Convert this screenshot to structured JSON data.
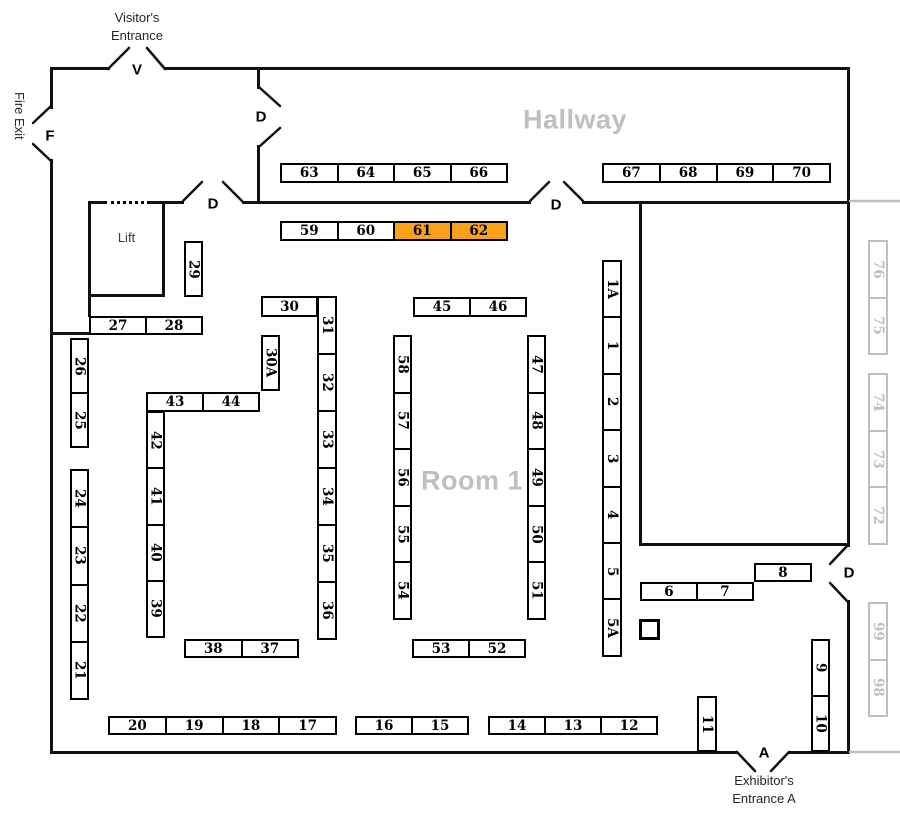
{
  "colors": {
    "highlight": "#F9A11B",
    "muted": "#BFBFBF",
    "wall": "#111111"
  },
  "rooms": [
    {
      "label": "Hallway",
      "x": 575,
      "y": 120
    },
    {
      "label": "Room 1",
      "x": 472,
      "y": 481
    }
  ],
  "lift": {
    "label": "Lift"
  },
  "entrances": {
    "visitor": {
      "lines": [
        "Visitor's",
        "Entrance"
      ]
    },
    "exhibitor": {
      "lines": [
        "Exhibitor's",
        "Entrance A"
      ]
    },
    "fire_exit": {
      "label": "Fire Exit"
    }
  },
  "markers": [
    {
      "label": "V",
      "x": 137,
      "y": 70
    },
    {
      "label": "F",
      "x": 50,
      "y": 136
    },
    {
      "label": "D",
      "x": 261,
      "y": 117
    },
    {
      "label": "D",
      "x": 213,
      "y": 204
    },
    {
      "label": "D",
      "x": 556,
      "y": 205
    },
    {
      "label": "D",
      "x": 849,
      "y": 573
    },
    {
      "label": "A",
      "x": 764,
      "y": 753
    }
  ],
  "highlighted_booths": [
    "61",
    "62"
  ],
  "booth_groups": [
    {
      "dir": "h",
      "x": 280,
      "y": 163,
      "cw": 57,
      "ch": 20,
      "cells": [
        "63",
        "64",
        "65",
        "66"
      ]
    },
    {
      "dir": "h",
      "x": 602,
      "y": 163,
      "cw": 57.25,
      "ch": 20,
      "cells": [
        "67",
        "68",
        "69",
        "70"
      ]
    },
    {
      "dir": "h",
      "x": 280,
      "y": 221,
      "cw": 57,
      "ch": 20,
      "cells": [
        "59",
        "60",
        "61",
        "62"
      ]
    },
    {
      "dir": "v",
      "x": 184,
      "y": 241,
      "cw": 19,
      "ch": 56,
      "cells": [
        "29"
      ]
    },
    {
      "dir": "h",
      "x": 89,
      "y": 316,
      "cw": 57,
      "ch": 19,
      "cells": [
        "27",
        "28"
      ]
    },
    {
      "dir": "v",
      "x": 70,
      "y": 338,
      "cw": 19,
      "ch": 55,
      "cells": [
        "26",
        "25"
      ]
    },
    {
      "dir": "v",
      "x": 70,
      "y": 469,
      "cw": 19,
      "ch": 57.75,
      "cells": [
        "24",
        "23",
        "22",
        "21"
      ]
    },
    {
      "dir": "h",
      "x": 146,
      "y": 392,
      "cw": 57,
      "ch": 20,
      "cells": [
        "43",
        "44"
      ]
    },
    {
      "dir": "v",
      "x": 146,
      "y": 411,
      "cw": 19,
      "ch": 56.75,
      "cells": [
        "42",
        "41",
        "40",
        "39"
      ]
    },
    {
      "dir": "h",
      "x": 261,
      "y": 296,
      "cw": 57,
      "ch": 21,
      "cells": [
        "30"
      ]
    },
    {
      "dir": "v",
      "x": 317,
      "y": 296,
      "cw": 20,
      "ch": 57.3,
      "cells": [
        "31",
        "32",
        "33",
        "34",
        "35",
        "36"
      ]
    },
    {
      "dir": "v",
      "x": 261,
      "y": 335,
      "cw": 19,
      "ch": 56,
      "cells": [
        "30A"
      ]
    },
    {
      "dir": "h",
      "x": 413,
      "y": 297,
      "cw": 57,
      "ch": 20,
      "cells": [
        "45",
        "46"
      ]
    },
    {
      "dir": "v",
      "x": 393,
      "y": 335,
      "cw": 19,
      "ch": 57,
      "cells": [
        "58",
        "57",
        "56",
        "55",
        "54"
      ]
    },
    {
      "dir": "v",
      "x": 527,
      "y": 335,
      "cw": 19,
      "ch": 57,
      "cells": [
        "47",
        "48",
        "49",
        "50",
        "51"
      ]
    },
    {
      "dir": "h",
      "x": 412,
      "y": 639,
      "cw": 57,
      "ch": 19,
      "cells": [
        "53",
        "52"
      ]
    },
    {
      "dir": "h",
      "x": 184,
      "y": 639,
      "cw": 57.5,
      "ch": 19,
      "cells": [
        "38",
        "37"
      ]
    },
    {
      "dir": "h",
      "x": 108,
      "y": 716,
      "cw": 57.25,
      "ch": 19,
      "cells": [
        "20",
        "19",
        "18",
        "17"
      ]
    },
    {
      "dir": "h",
      "x": 355,
      "y": 716,
      "cw": 57,
      "ch": 19,
      "cells": [
        "16",
        "15"
      ]
    },
    {
      "dir": "h",
      "x": 488,
      "y": 716,
      "cw": 56.7,
      "ch": 19,
      "cells": [
        "14",
        "13",
        "12"
      ]
    },
    {
      "dir": "v",
      "x": 602,
      "y": 260,
      "cw": 20,
      "ch": 56.7,
      "cells": [
        "1A",
        "1",
        "2",
        "3",
        "4",
        "5",
        "5A"
      ]
    },
    {
      "dir": "h",
      "x": 640,
      "y": 582,
      "cw": 57,
      "ch": 19,
      "cells": [
        "6",
        "7"
      ]
    },
    {
      "dir": "h",
      "x": 754,
      "y": 563,
      "cw": 58,
      "ch": 19,
      "cells": [
        "8"
      ]
    },
    {
      "dir": "v",
      "x": 811,
      "y": 639,
      "cw": 19,
      "ch": 56.5,
      "cells": [
        "9",
        "10"
      ]
    },
    {
      "dir": "v",
      "x": 697,
      "y": 696,
      "cw": 20,
      "ch": 56,
      "cells": [
        "11"
      ]
    },
    {
      "dir": "v",
      "x": 868,
      "y": 240,
      "cw": 20,
      "ch": 57.5,
      "muted": true,
      "cells": [
        "76",
        "75"
      ]
    },
    {
      "dir": "v",
      "x": 868,
      "y": 373,
      "cw": 20,
      "ch": 57.3,
      "muted": true,
      "cells": [
        "74",
        "73",
        "72"
      ]
    },
    {
      "dir": "v",
      "x": 868,
      "y": 602,
      "cw": 20,
      "ch": 57.5,
      "muted": true,
      "cells": [
        "99",
        "98"
      ]
    }
  ],
  "door_marks": [
    [
      108,
      69,
      129,
      48
    ],
    [
      147,
      48,
      165,
      69
    ],
    [
      50,
      107,
      33,
      123
    ],
    [
      33,
      144,
      50,
      160
    ],
    [
      260,
      88,
      280,
      106
    ],
    [
      280,
      128,
      260,
      146
    ],
    [
      183,
      201,
      202,
      182
    ],
    [
      223,
      182,
      242,
      201
    ],
    [
      530,
      201,
      549,
      182
    ],
    [
      564,
      182,
      583,
      201
    ],
    [
      847,
      546,
      830,
      564
    ],
    [
      830,
      583,
      847,
      601
    ],
    [
      737,
      752,
      755,
      771
    ],
    [
      771,
      771,
      789,
      752
    ]
  ],
  "gray_lines": [
    [
      850,
      201,
      900,
      201
    ],
    [
      850,
      752,
      900,
      752
    ]
  ]
}
